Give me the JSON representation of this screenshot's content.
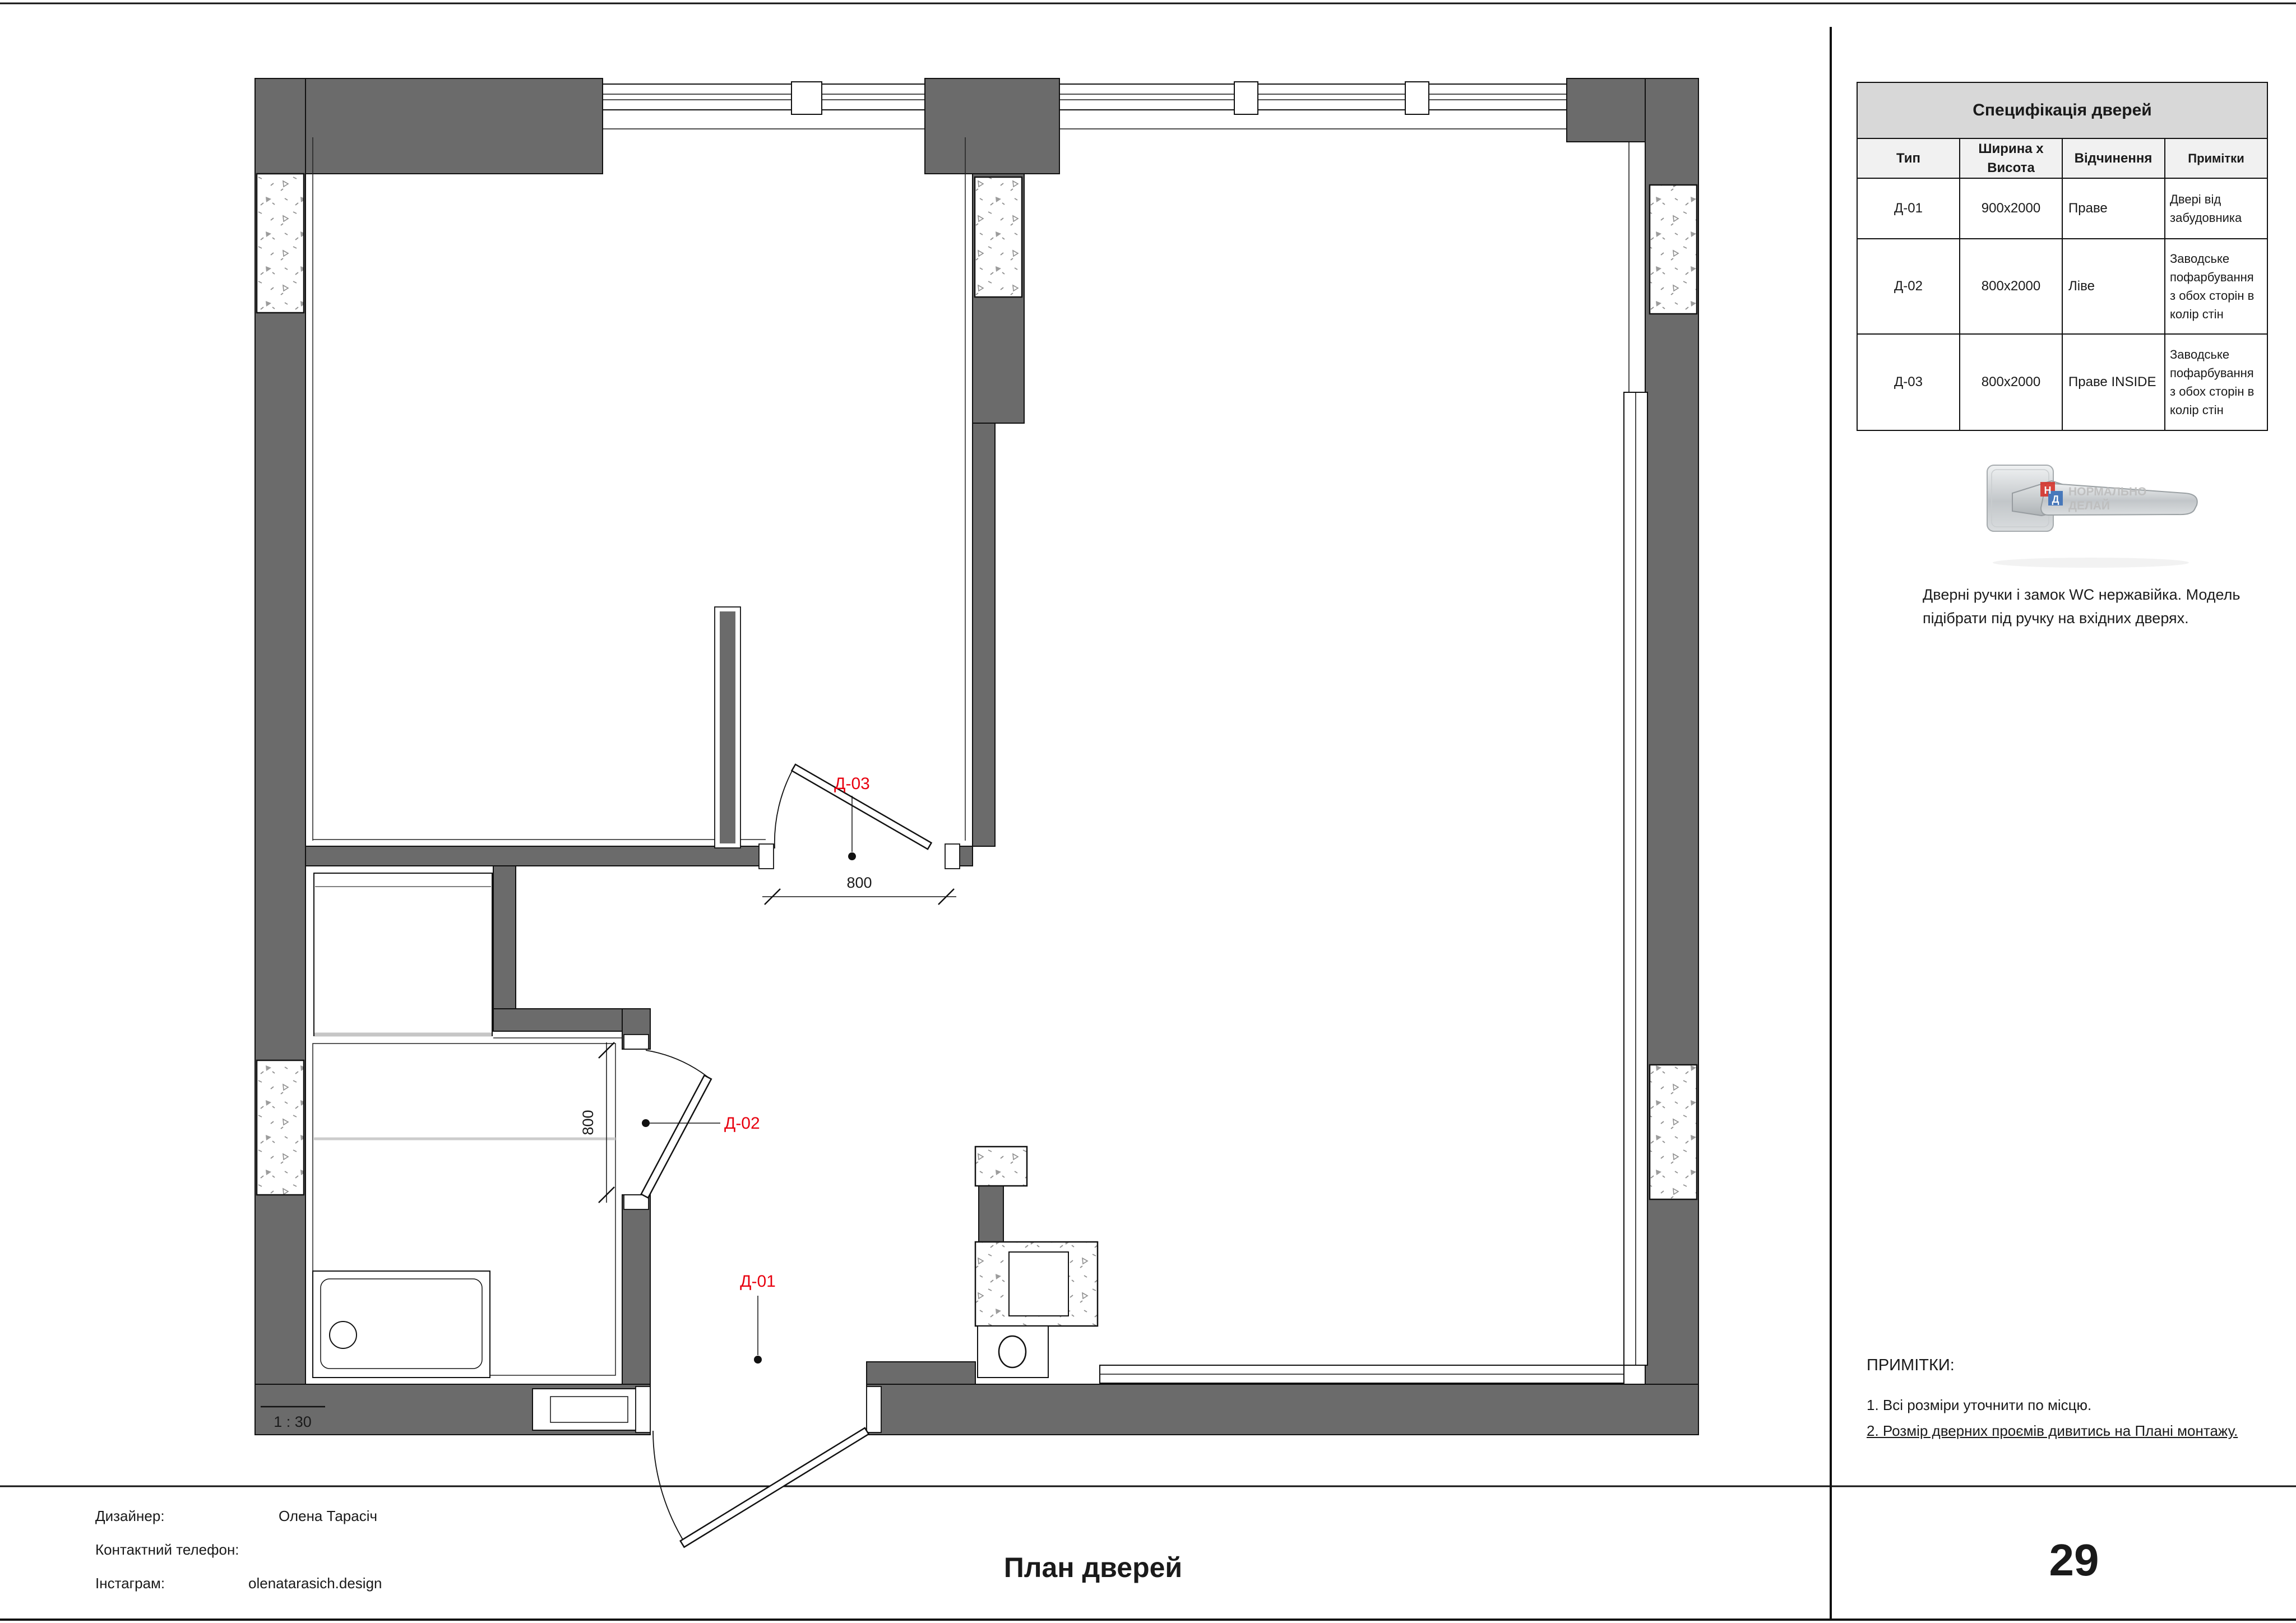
{
  "page": {
    "title": "План дверей",
    "page_number": "29",
    "scale_label": "1 : 30"
  },
  "footer": {
    "designer_label": "Дизайнер:",
    "designer_value": "Олена Тарасіч",
    "phone_label": "Контактний телефон:",
    "instagram_label": "Інстаграм:",
    "instagram_value": "olenatarasich.design"
  },
  "spec_table": {
    "title": "Специфікація дверей",
    "headers": [
      "Тип",
      "Ширина х Висота",
      "Відчинення",
      "Примітки"
    ],
    "rows": [
      {
        "type": "Д-01",
        "size": "900х2000",
        "opening": "Праве",
        "notes": "Двері від забудовника"
      },
      {
        "type": "Д-02",
        "size": "800х2000",
        "opening": "Ліве",
        "notes": "Заводське пофарбування з обох сторін в колір стін"
      },
      {
        "type": "Д-03",
        "size": "800х2000",
        "opening": "Праве INSIDE",
        "notes": "Заводське пофарбування з обох сторін в колір стін"
      }
    ]
  },
  "handle": {
    "caption_line1": "Дверні ручки і замок WC нержавійка. Модель",
    "caption_line2": "підібрати під ручку на вхідних дверях.",
    "watermark_letter1": "Н",
    "watermark_letter2": "Д",
    "watermark_text1": "НОРМАЛЬНО",
    "watermark_text2": "ДЕЛАЙ"
  },
  "notes": {
    "title": "ПРИМІТКИ:",
    "item1": "1. Всі розміри уточнити по місцю.",
    "item2": "2. Розмір дверних проємів дивитись на Плані монтажу."
  },
  "plan": {
    "labels": {
      "d01": "Д-01",
      "d02": "Д-02",
      "d03": "Д-03"
    },
    "dims": {
      "d02_width": "800",
      "d03_width": "800"
    },
    "colors": {
      "wall_fill": "#6b6b6b",
      "label_red": "#e8000f",
      "table_title_bg": "#d8d8d8",
      "table_header_bg": "#f1f1f1"
    }
  }
}
